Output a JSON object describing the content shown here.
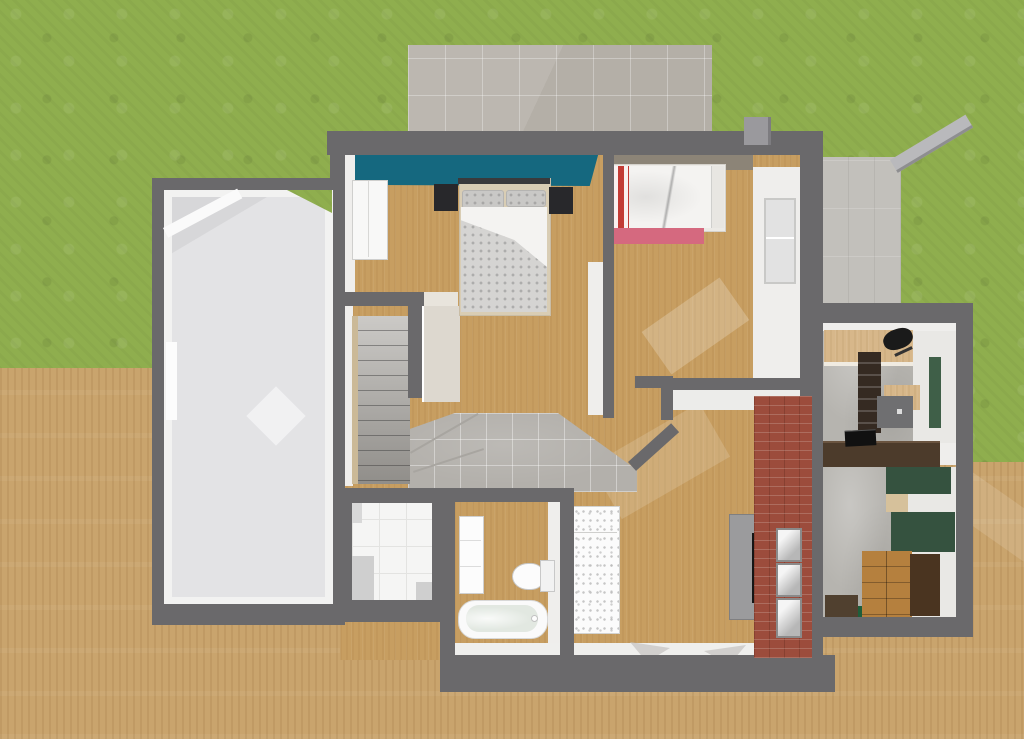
{
  "scene": {
    "type": "3d-floor-plan-aerial-render",
    "description": "Top-down 3D rendering of a house with garage, bedrooms, bathroom, staircase, living room and side annex on a grass lot with wooden deck terrain"
  },
  "palette": {
    "grass": "#8fae4e",
    "ground_wood": "#c9a46d",
    "ground_wood_light": "#d2ad77",
    "wall": "#6a696b",
    "wall_face": "#efeeec",
    "floor_wood": "#c79e61",
    "teal_wall": "#15687f",
    "taupe_wall": "#8c8477",
    "driveway": "#b4afa7",
    "terrace": "#c2c0bb",
    "garden_wall": "#b9b9bc",
    "pillar": "#9a999d",
    "garage_floor": "#e3e3e5",
    "garage_inner": "#f2f2f1",
    "hall_tile": "#b3b0ab",
    "stair_base": "#b0ada8",
    "stair_side": "#cbb997",
    "landing": "#ddd8cf",
    "doorway_light": "#e8e4dc",
    "white_tile": "#f5f5f4",
    "shadow_tile": "#cfcfcf",
    "bed_frame_tan": "#d9cdb4",
    "duvet_gray": "#d5d4d2",
    "duvet_white": "#f4f3f1",
    "pillow_gray": "#c9c8c6",
    "headboard_dark": "#3a3a3c",
    "nightstand": "#28282b",
    "wardrobe": "#f8f8f7",
    "kids_red": "#c23b35",
    "kids_duvet": "#f4f3f1",
    "kids_frame": "#eceae6",
    "pink_rug": "#d5697f",
    "white_bed": "#fbfbfb",
    "brick": "#9c4c3c",
    "console_gray": "#9b9b9d",
    "tv_black": "#151515",
    "frame_gray": "#d9d9d9",
    "fixture_white": "#fcfcfc",
    "tub_outer": "#fafafa",
    "tub_inner": "#e2e8e1",
    "concrete": "#b6b4af",
    "annex_white_floor": "#e9e8e5",
    "desk_wood": "#d7b78a",
    "office_chair": "#1a1a1a",
    "bookcase_brown": "#352a22",
    "office_mat": "#6f6f71",
    "runner_green": "#3f5f48",
    "divider_brown": "#4c3b2b",
    "laptop_black": "#111111",
    "panel_green": "#35523f",
    "tan_patch": "#d6c19b",
    "dresser_wood": "#b5803e",
    "dresser_side": "#4a3420",
    "box_brown": "#50402f",
    "rug_green": "#1e5e3b",
    "window_glass": "#e2e2e2",
    "arrow_gray": "#c4c2bf"
  },
  "outdoor": {
    "items": [
      {
        "name": "grass-lawn"
      },
      {
        "name": "wood-deck-left"
      },
      {
        "name": "wood-deck-right"
      },
      {
        "name": "driveway-patio"
      },
      {
        "name": "gate-pillar"
      },
      {
        "name": "side-terrace"
      },
      {
        "name": "diagonal-garden-wall"
      }
    ]
  },
  "rooms": [
    {
      "name": "garage",
      "floor": "light-gray",
      "features": [
        "beveled-corner",
        "left-wall-window",
        "grass-notch"
      ]
    },
    {
      "name": "master-bedroom",
      "accent_wall": "teal",
      "furniture": [
        "double-bed",
        "two-nightstands",
        "wardrobe"
      ]
    },
    {
      "name": "kids-bedroom",
      "accent_wall": "taupe",
      "furniture": [
        "single-bed-red-white",
        "pink-rug",
        "window"
      ]
    },
    {
      "name": "stairwell",
      "furniture": [
        "l-shaped-staircase",
        "upper-landing"
      ]
    },
    {
      "name": "hallway",
      "floor": "gray-tiles"
    },
    {
      "name": "utility-room",
      "floor": "white-tiles"
    },
    {
      "name": "bathroom",
      "furniture": [
        "shower-panel",
        "toilet",
        "bathtub"
      ]
    },
    {
      "name": "living-room",
      "furniture": [
        "white-daybed",
        "tv-console",
        "tv",
        "brick-fireplace-wall",
        "three-wall-frames"
      ]
    },
    {
      "name": "annex-office",
      "furniture": [
        "desk",
        "office-chair",
        "bookcase",
        "chair-mat",
        "green-runner",
        "laptop",
        "brown-divider"
      ]
    },
    {
      "name": "annex-dressing-room",
      "furniture": [
        "green-wall-panels",
        "wood-dresser",
        "brown-box",
        "green-rug"
      ]
    }
  ]
}
